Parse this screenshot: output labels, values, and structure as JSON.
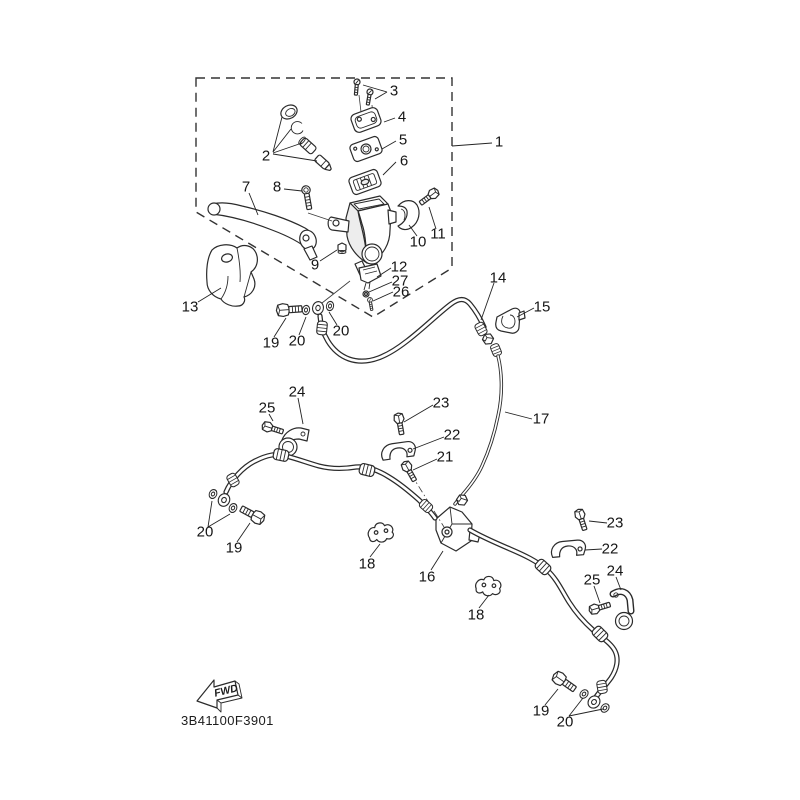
{
  "diagram": {
    "drawing_code": "3B41100F3901",
    "fwd_label": "FWD",
    "colors": {
      "line": "#2b2b2b",
      "label": "#161616",
      "background": "#ffffff"
    },
    "callouts": [
      {
        "ref": "frame",
        "label": "1"
      },
      {
        "ref": "piston-kit",
        "label": "2"
      },
      {
        "ref": "cap-screws",
        "label": "3"
      },
      {
        "ref": "reservoir-cap",
        "label": "4"
      },
      {
        "ref": "cap-plate",
        "label": "5"
      },
      {
        "ref": "diaphragm",
        "label": "6"
      },
      {
        "ref": "brake-lever",
        "label": "7"
      },
      {
        "ref": "pivot-bolt",
        "label": "8"
      },
      {
        "ref": "pivot-nut",
        "label": "9"
      },
      {
        "ref": "bracket-clamp",
        "label": "10"
      },
      {
        "ref": "clamp-bolt",
        "label": "11"
      },
      {
        "ref": "brake-switch",
        "label": "12"
      },
      {
        "ref": "switch-washer",
        "label": "27"
      },
      {
        "ref": "switch-screw",
        "label": "26"
      },
      {
        "ref": "lever-guard",
        "label": "13"
      },
      {
        "ref": "union-bolt-top",
        "label": "19"
      },
      {
        "ref": "washer-top-1",
        "label": "20"
      },
      {
        "ref": "washer-top-2",
        "label": "20"
      },
      {
        "ref": "upper-hose",
        "label": "14"
      },
      {
        "ref": "hose-clip",
        "label": "15"
      },
      {
        "ref": "brake-pipe",
        "label": "17"
      },
      {
        "ref": "guard-bracket-1",
        "label": "24"
      },
      {
        "ref": "bracket-bolt-1",
        "label": "25"
      },
      {
        "ref": "clamp-bolt-mid",
        "label": "23"
      },
      {
        "ref": "hose-clamp-mid",
        "label": "22"
      },
      {
        "ref": "joint-bolt",
        "label": "21"
      },
      {
        "ref": "washers-left",
        "label": "20"
      },
      {
        "ref": "union-bolt-left",
        "label": "19"
      },
      {
        "ref": "wire-clip-1",
        "label": "18"
      },
      {
        "ref": "joint-block",
        "label": "16"
      },
      {
        "ref": "wire-clip-2",
        "label": "18"
      },
      {
        "ref": "clamp-bolt-rt",
        "label": "23"
      },
      {
        "ref": "hose-clamp-rt",
        "label": "22"
      },
      {
        "ref": "bracket-bolt-2",
        "label": "25"
      },
      {
        "ref": "guard-bracket-2",
        "label": "24"
      },
      {
        "ref": "union-bolt-br",
        "label": "19"
      },
      {
        "ref": "washers-br",
        "label": "20"
      }
    ]
  }
}
